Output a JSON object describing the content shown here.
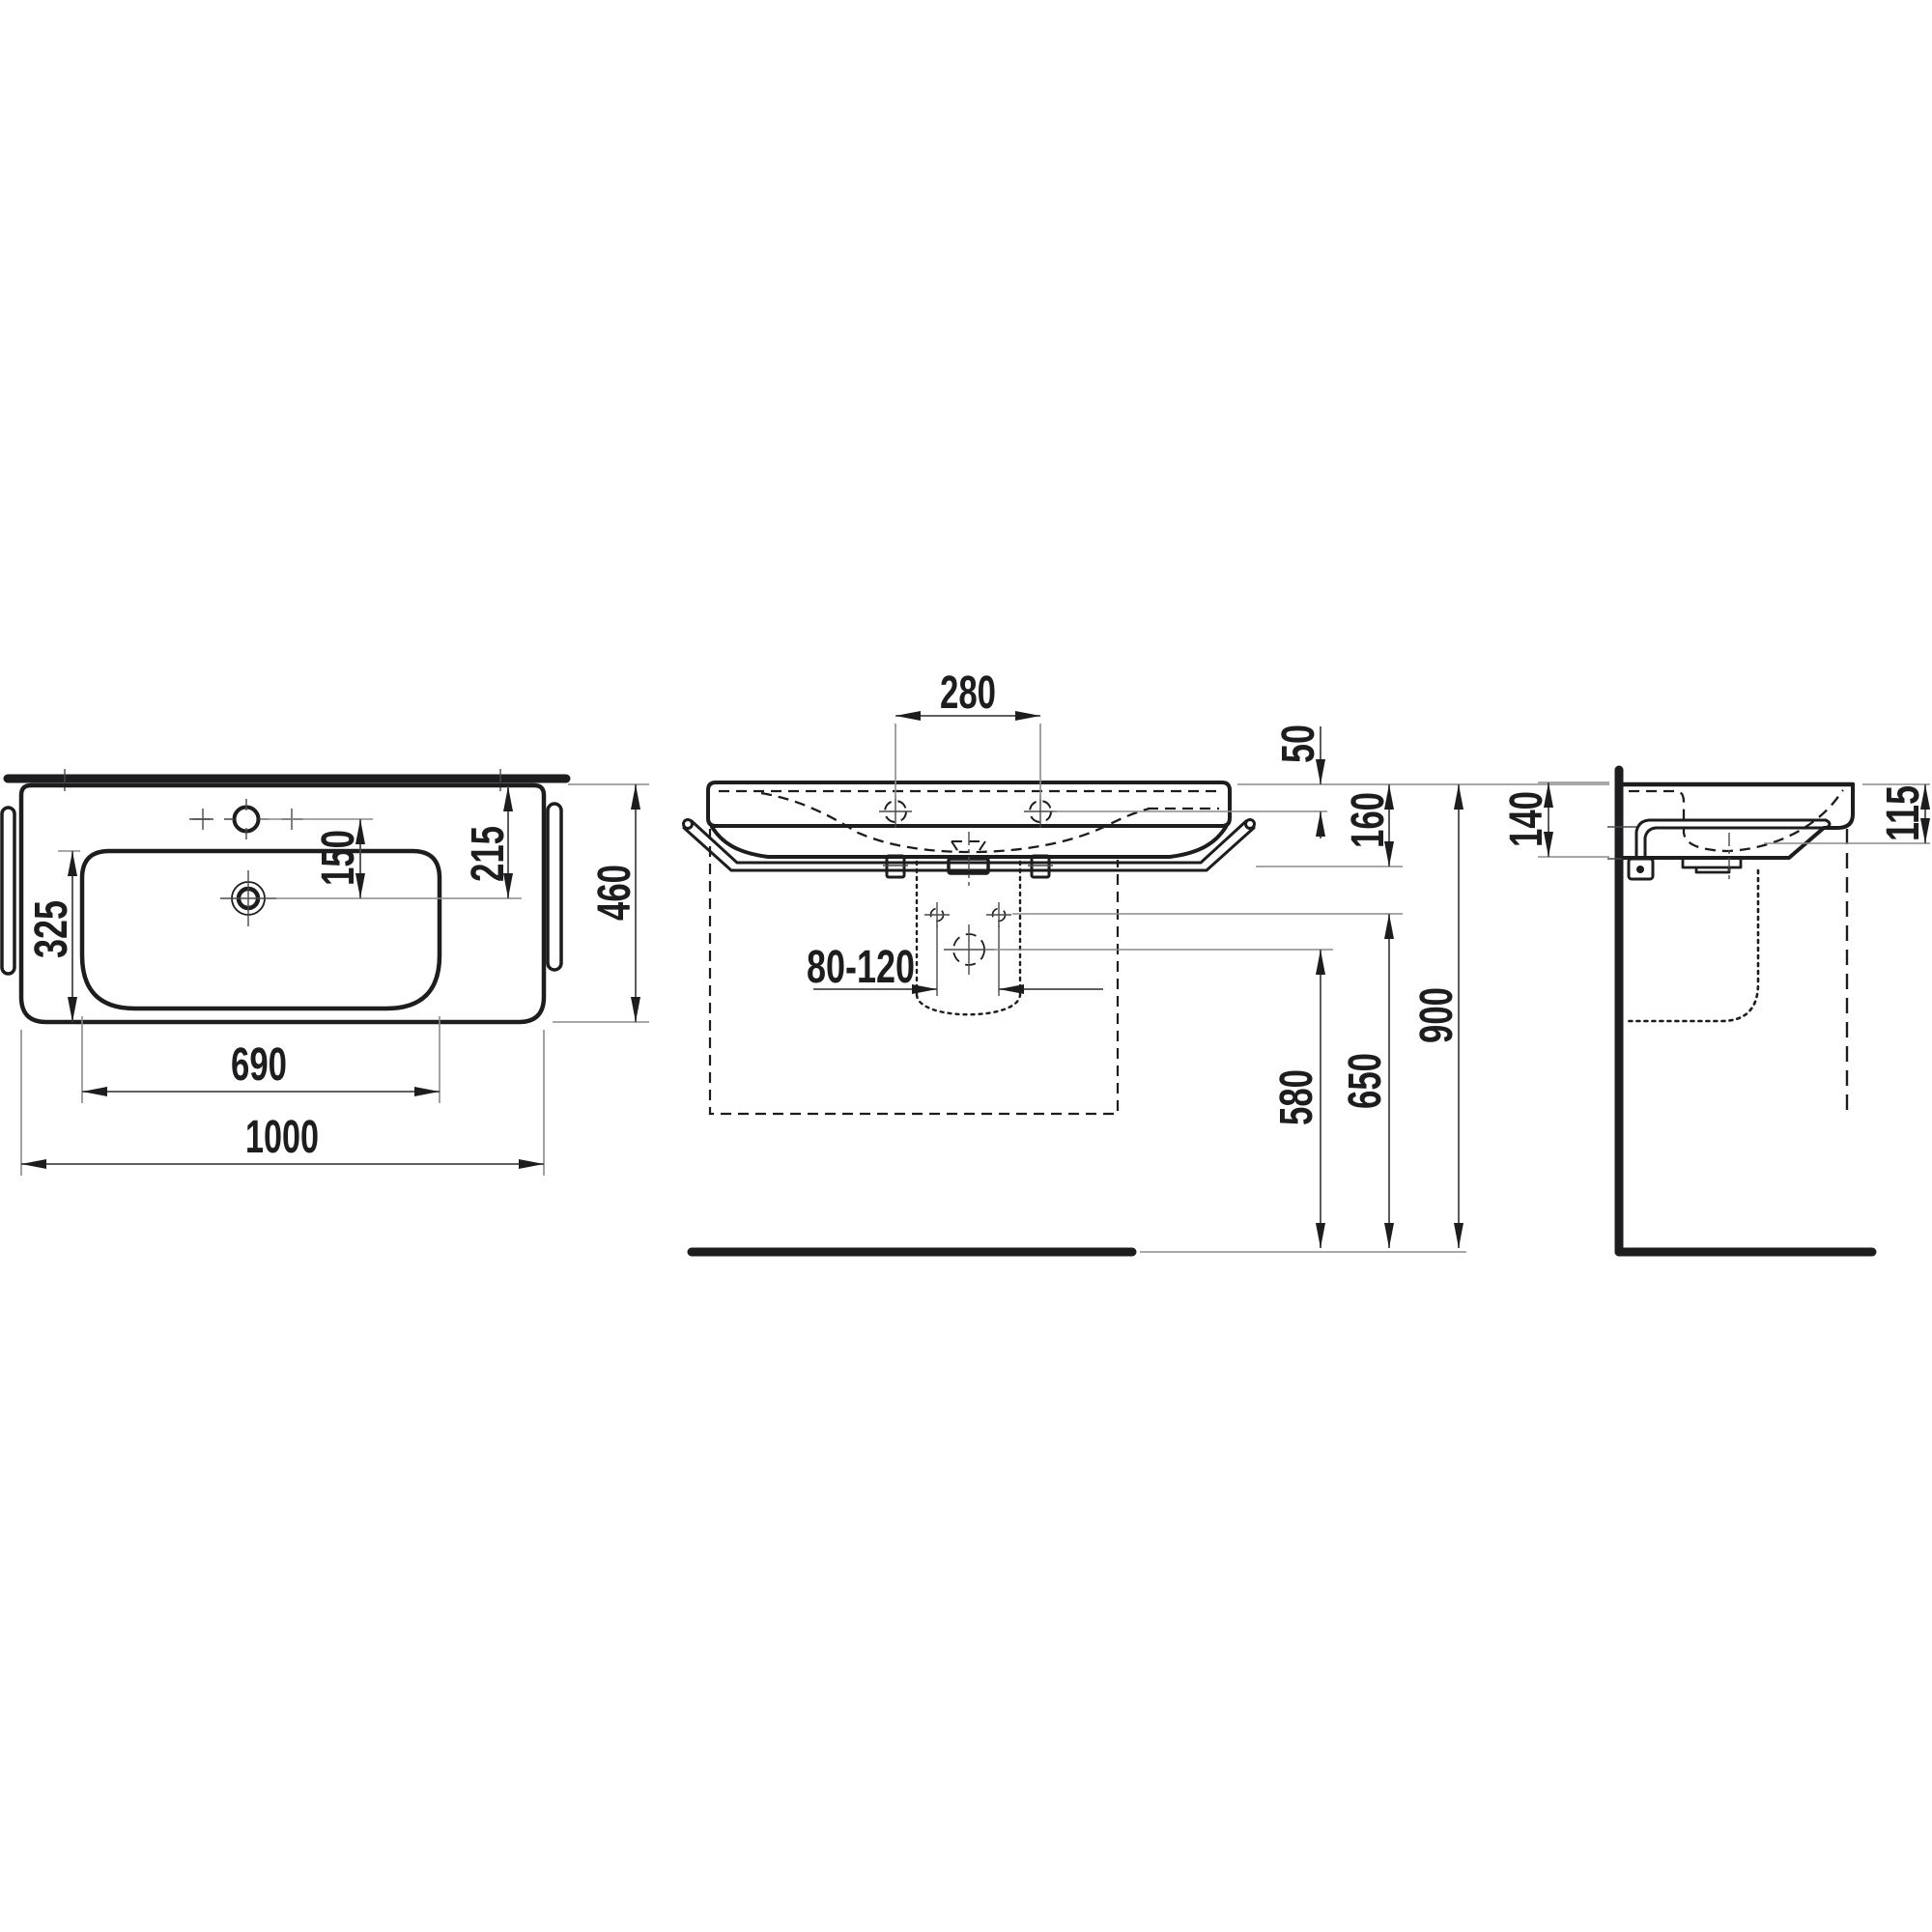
{
  "drawing_title": "wall-hung washbasin installation drawing, three orthographic views",
  "views": {
    "plan": "top view with bowl, tap holes and drain",
    "front": "front elevation with tap holes, fixing bolts, siphon space and floor line",
    "side": "side elevation with wall, towel rail and waste pipe"
  },
  "dims": {
    "w1000": "1000",
    "w690": "690",
    "d460": "460",
    "d325": "325",
    "d150": "150",
    "d215": "215",
    "s280": "280",
    "r80120": "80-120",
    "h50": "50",
    "h160": "160",
    "h580": "580",
    "h650": "650",
    "h900": "900",
    "sd140": "140",
    "sd115": "115"
  },
  "colors": {
    "line": "#1d1d1f",
    "dim_line": "#4a4a4a",
    "extension_line": "#8c8c8c",
    "background": "#ffffff"
  }
}
